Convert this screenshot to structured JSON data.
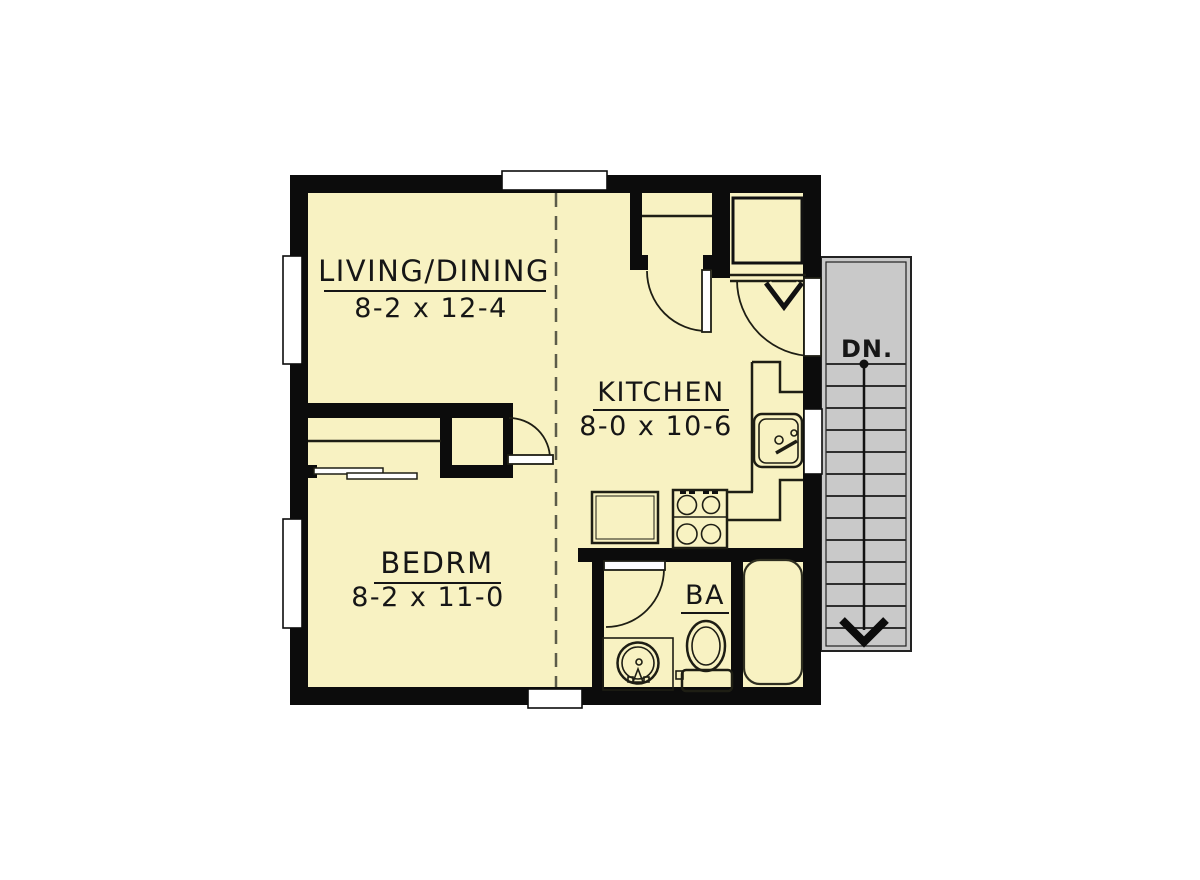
{
  "plan": {
    "type": "floor-plan",
    "rooms": [
      {
        "name": "living-dining",
        "label": "LIVING/DINING",
        "dimensions": "8-2 x 12-4"
      },
      {
        "name": "kitchen",
        "label": "KITCHEN",
        "dimensions": "8-0 x 10-6"
      },
      {
        "name": "bedroom",
        "label": "BEDRM",
        "dimensions": "8-2 x 11-0"
      },
      {
        "name": "bathroom",
        "label": "BA",
        "dimensions": ""
      }
    ],
    "stairs": {
      "label": "DN.",
      "direction": "down",
      "tread_count": 13
    },
    "fixtures": [
      "kitchen-sink",
      "range-stove",
      "refrigerator",
      "kitchen-counter",
      "entry-closet-shelf",
      "bedroom-closet-shelf-rod",
      "water-heater",
      "vent-v-symbol",
      "vanity-sink",
      "toilet",
      "bathtub"
    ],
    "windows": [
      "top-window",
      "left-window-upper",
      "left-window-lower",
      "bottom-window",
      "kitchen-right-window"
    ],
    "doors": [
      "entry-closet-door",
      "bedroom-door",
      "bathroom-door",
      "unit-entry-door"
    ],
    "colors": {
      "floor": "#f8f2c2",
      "wall": "#0c0c0c",
      "line": "#1e1e14",
      "stairs_fill": "#c9c9c9",
      "stairs_line": "#2f2f2f",
      "dashed": "#5c5c49",
      "window": "#ffffff",
      "background": "#ffffff"
    }
  }
}
